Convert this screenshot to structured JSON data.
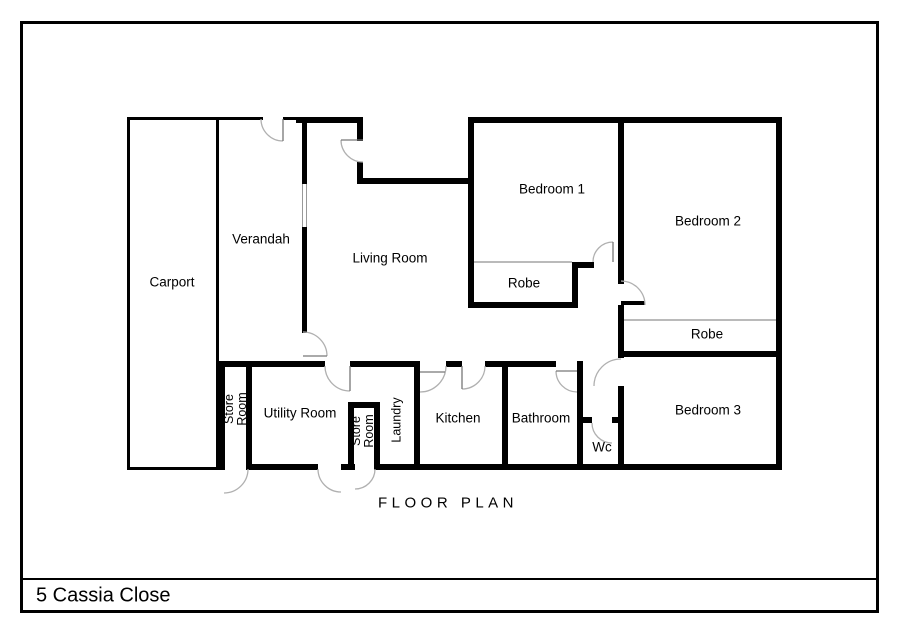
{
  "page": {
    "title": "FLOOR PLAN",
    "address": "5 Cassia Close"
  },
  "rooms": {
    "carport": "Carport",
    "verandah": "Verandah",
    "living_room": "Living Room",
    "bedroom_1": "Bedroom 1",
    "bedroom_2": "Bedroom 2",
    "bedroom_3": "Bedroom 3",
    "robe_1": "Robe",
    "robe_2": "Robe",
    "store_room_1": "Store Room",
    "store_room_2": "Store Room",
    "utility_room": "Utility Room",
    "laundry": "Laundry",
    "kitchen": "Kitchen",
    "bathroom": "Bathroom",
    "wc": "Wc"
  },
  "colors": {
    "wall": "#000000",
    "door_arc": "#b0b0b0",
    "door_leaf": "#777777",
    "window_line": "#999999",
    "background": "#ffffff",
    "text": "#000000"
  }
}
